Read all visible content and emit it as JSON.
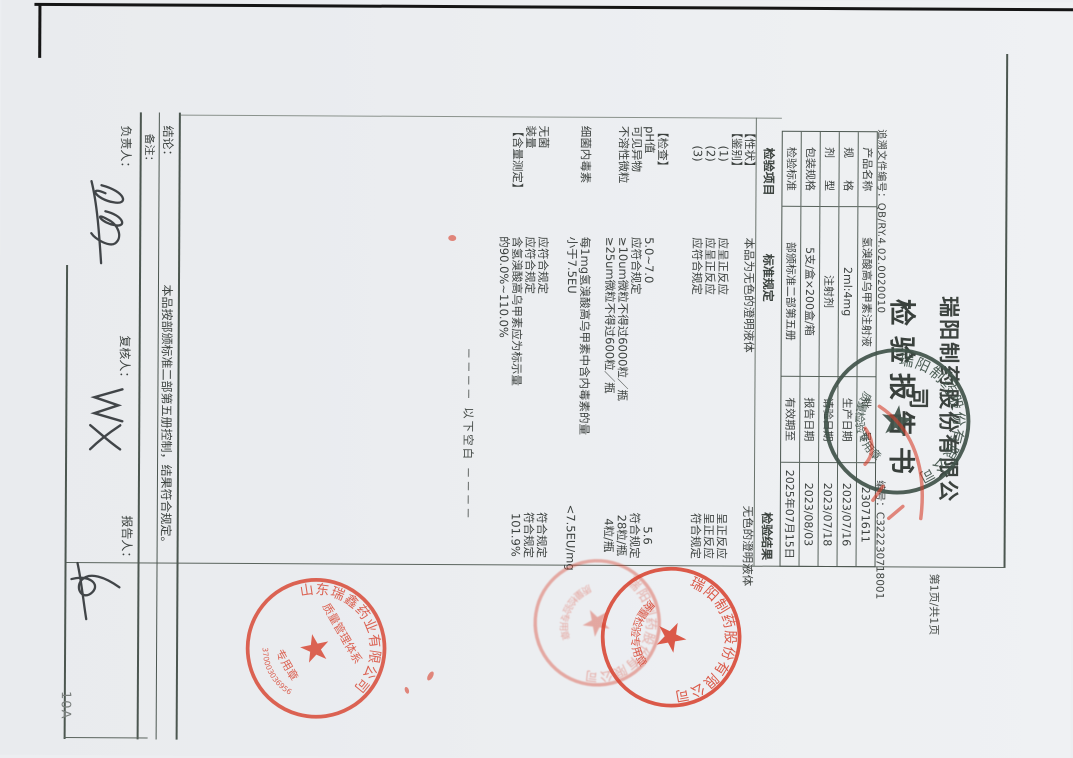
{
  "header": {
    "trace_label": "追溯文件编号：",
    "trace_value": "QB/RY.4.02.0020010",
    "company": "瑞阳制药股份有限公司",
    "title": "检验报告书",
    "page_info": "第1页/共1页",
    "report_no_label": "编号：",
    "report_no": "C322230718001"
  },
  "product_table": {
    "rows": [
      {
        "c1": "产品名称",
        "c2": "氢溴酸高乌甲素注射液",
        "c3": "批　　号",
        "c4": "23071611"
      },
      {
        "c1": "规　　格",
        "c2": "2ml:4mg",
        "c3": "生产日期",
        "c4": "2023/07/16"
      },
      {
        "c1": "剂　　型",
        "c2": "注射剂",
        "c3": "请验日期",
        "c4": "2023/07/18"
      },
      {
        "c1": "包装规格",
        "c2": "5支/盒×200盒/箱",
        "c3": "报告日期",
        "c4": "2023/08/03"
      },
      {
        "c1": "检验标准",
        "c2": "部颁标准二部第五册",
        "c3": "有效期至",
        "c4": "2025年07月15日"
      }
    ]
  },
  "test_table": {
    "headers": [
      "检验项目",
      "标准规定",
      "检验结果"
    ],
    "rows": [
      {
        "item": "【性状】",
        "std": "本品为无色的澄明液体",
        "result": "无色的澄明液体"
      },
      {
        "item": "【鉴别】",
        "std": "",
        "result": ""
      },
      {
        "item": "(1)",
        "std": "应呈正反应",
        "result": "呈正反应"
      },
      {
        "item": "(2)",
        "std": "应呈正反应",
        "result": "呈正反应"
      },
      {
        "item": "(3)",
        "std": "应符合规定",
        "result": "符合规定"
      },
      {
        "item": "【检查】",
        "std": "",
        "result": ""
      },
      {
        "item": "pH值",
        "std": "5.0~7.0",
        "result": "5.6"
      },
      {
        "item": "可见异物",
        "std": "应符合规定",
        "result": "符合规定"
      },
      {
        "item": "不溶性微粒",
        "std": "≥10um微粒不得过6000粒／瓶",
        "result": "28粒/瓶"
      },
      {
        "item": "",
        "std": "≥25um微粒不得过600粒／瓶",
        "result": "4粒/瓶"
      },
      {
        "item": "细菌内毒素",
        "std": "每1mg氢溴酸高乌甲素中含内毒素的量",
        "result": ""
      },
      {
        "item": "",
        "std": "小于7.5EU",
        "result": "<7.5EU/mg"
      },
      {
        "item": "无菌",
        "std": "应符合规定",
        "result": "符合规定"
      },
      {
        "item": "装量",
        "std": "应符合规定",
        "result": "符合规定"
      },
      {
        "item": "【含量测定】",
        "std": "含氢溴酸高乌甲素应为标示量",
        "result": "101.9%"
      },
      {
        "item": "",
        "std": "的90.0%~110.0%",
        "result": ""
      }
    ],
    "blank_note": "－－－－ 以下空白 －－－－"
  },
  "footer": {
    "conclusion_label": "结论：",
    "conclusion": "本品按部颁标准二部第五册控制，结果符合规定。",
    "remark_label": "备注：",
    "responsible_label": "负责人：",
    "reviewer_label": "复核人：",
    "reporter_label": "报告人："
  },
  "stamps": {
    "qc_dark": {
      "company": "瑞阳制药股份有限公司",
      "inner": "质量检验专用章"
    },
    "qms_red": {
      "company": "山东瑞鑫药业有限公司",
      "inner_line1": "质量管理体系",
      "inner_line2": "专用章",
      "serial": "370003036956"
    },
    "qc_red": {
      "company": "瑞阳制药股份有限公司",
      "inner": "质量检验专用章"
    },
    "faint_red": {
      "company": "瑞阳制药股份有限公司",
      "inner": "质量检验专用章"
    }
  },
  "scan": {
    "page_code": "10A"
  },
  "colors": {
    "stamp_red": "#d8402c",
    "stamp_dark": "#41534a",
    "ink": "#3b403e"
  }
}
